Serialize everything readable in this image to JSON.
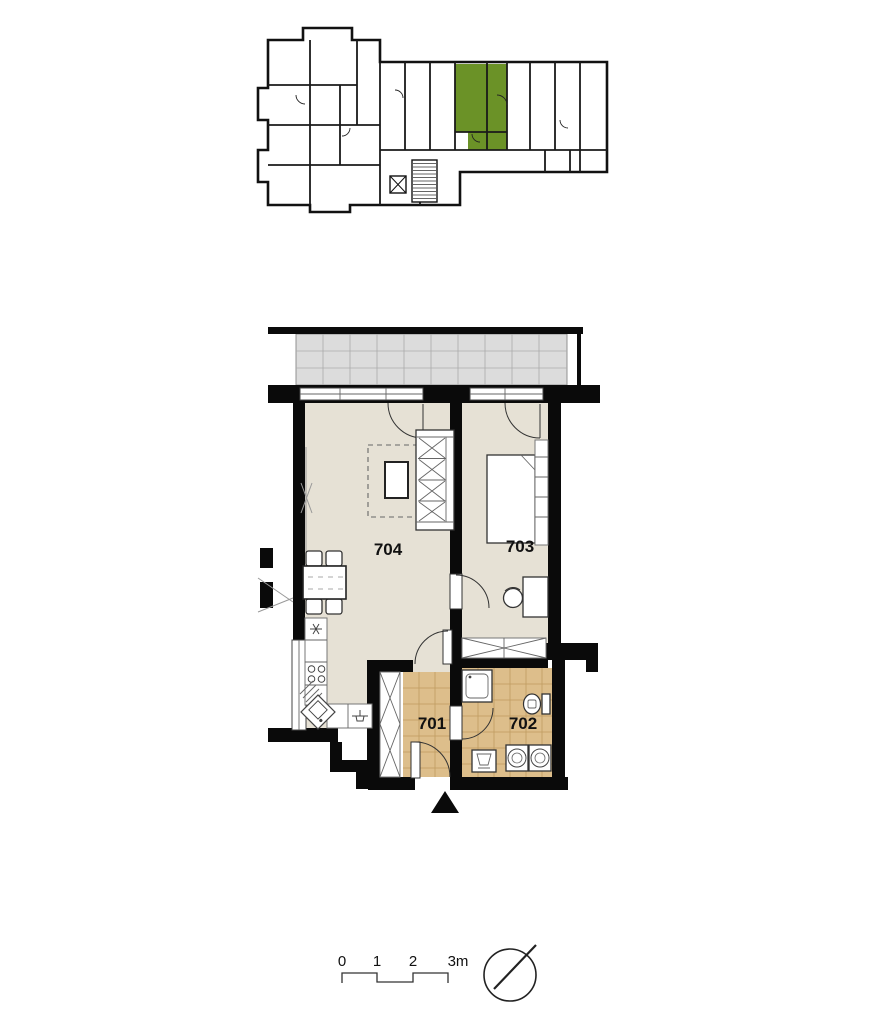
{
  "overview": {
    "highlight_color": "#6b9227",
    "wall_color": "#111111"
  },
  "plan": {
    "rooms": [
      {
        "label": "701"
      },
      {
        "label": "702"
      },
      {
        "label": "703"
      },
      {
        "label": "704"
      }
    ],
    "colors": {
      "floor": "#e6e1d5",
      "tile": "#ddbe8b",
      "tile_grid": "#b99256",
      "balcony": "#dcdcdc",
      "wall": "#0a0a0a"
    }
  },
  "scale_bar": {
    "labels": [
      "0",
      "1",
      "2",
      "3m"
    ]
  },
  "icons": {
    "north_indicator": "compass-needle-icon",
    "entrance_marker": "entrance-triangle-icon"
  }
}
